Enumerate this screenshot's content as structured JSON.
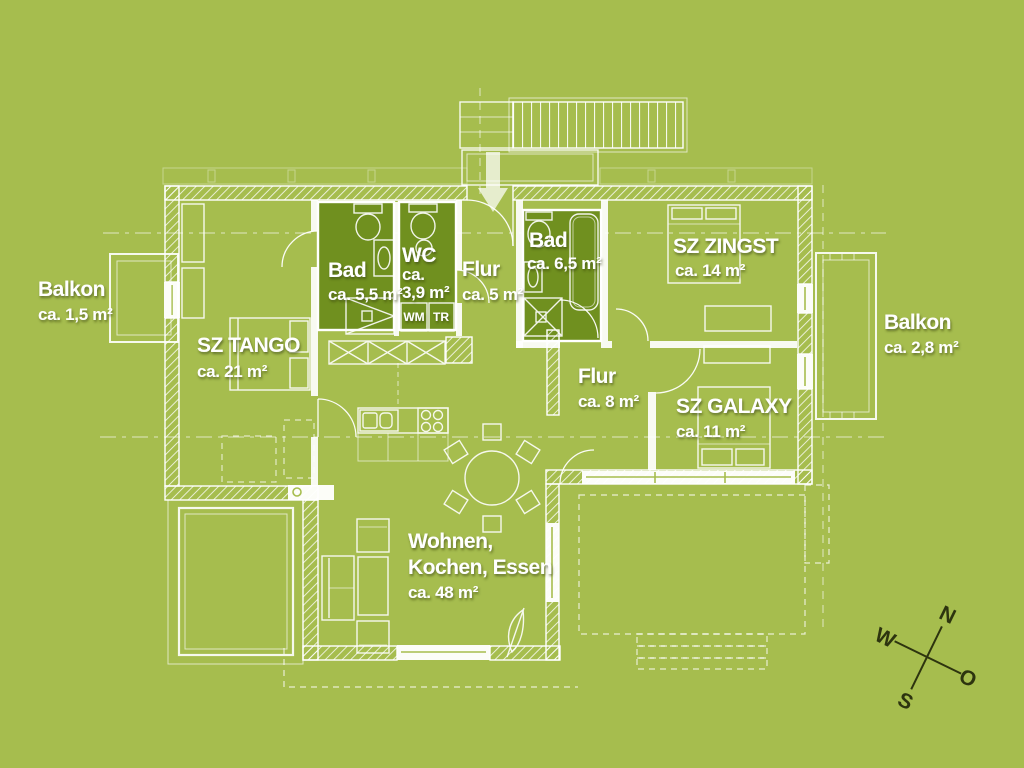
{
  "rooms": {
    "balkon_left": {
      "name": "Balkon",
      "area": "ca. 1,5 m²"
    },
    "sz_tango": {
      "name": "SZ TANGO",
      "area": "ca. 21 m²"
    },
    "bad_55": {
      "name": "Bad",
      "area": "ca. 5,5 m²"
    },
    "wc": {
      "name": "WC",
      "area_line1": "ca.",
      "area_line2": "3,9 m²"
    },
    "flur_5": {
      "name": "Flur",
      "area": "ca. 5 m²"
    },
    "bad_65": {
      "name": "Bad",
      "area": "ca. 6,5 m²"
    },
    "sz_zingst": {
      "name": "SZ ZINGST",
      "area": "ca. 14 m²"
    },
    "balkon_right": {
      "name": "Balkon",
      "area": "ca. 2,8 m²"
    },
    "flur_8": {
      "name": "Flur",
      "area": "ca. 8 m²"
    },
    "sz_galaxy": {
      "name": "SZ GALAXY",
      "area": "ca. 11 m²"
    },
    "wohnen": {
      "name_line1": "Wohnen,",
      "name_line2": "Kochen, Essen",
      "area": "ca. 48 m²"
    }
  },
  "appliances": {
    "washing_machine": "WM",
    "dryer": "TR"
  },
  "compass": {
    "north": "N",
    "east": "O",
    "south": "S",
    "west": "W"
  },
  "colors": {
    "background": "#a6bd4e",
    "room_highlight": "#70901f",
    "lines": "#ffffff",
    "compass": "#2d340f"
  }
}
